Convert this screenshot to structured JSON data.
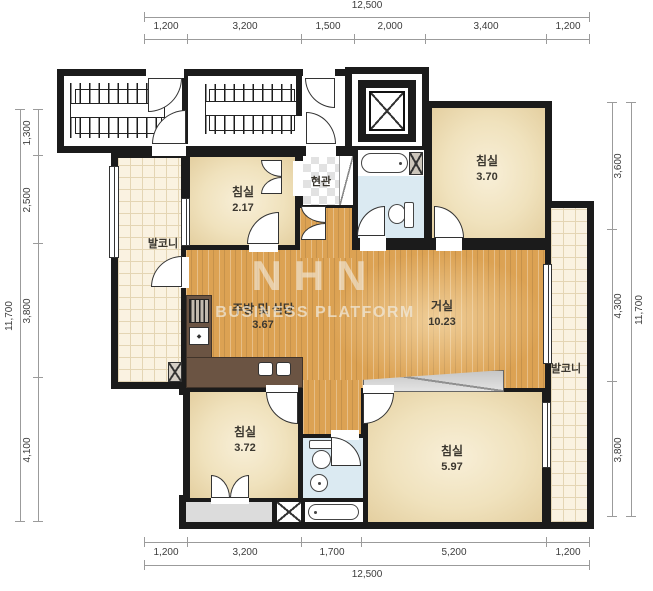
{
  "meta": {
    "type": "apartment-floor-plan"
  },
  "watermark": {
    "line1": "NHN",
    "line2": "BUSINESS PLATFORM"
  },
  "dimensions": {
    "top": {
      "total": "12,500",
      "segments": [
        "1,200",
        "3,200",
        "1,500",
        "2,000",
        "3,400",
        "1,200"
      ]
    },
    "bottom": {
      "total": "12,500",
      "segments": [
        "1,200",
        "3,200",
        "1,700",
        "5,200",
        "1,200"
      ]
    },
    "left": {
      "total": "11,700",
      "segments": [
        "1,300",
        "2,500",
        "3,800",
        "4,100"
      ]
    },
    "right": {
      "total": "11,700",
      "segments": [
        "3,600",
        "4,300",
        "3,800"
      ]
    }
  },
  "rooms": {
    "bedroom_top_left": {
      "name": "침실",
      "area": "2.17"
    },
    "bedroom_top_right": {
      "name": "침실",
      "area": "3.70"
    },
    "living_room": {
      "name": "거실",
      "area": "10.23"
    },
    "kitchen_dining": {
      "name": "주방 및 식당",
      "area": "3.67"
    },
    "bedroom_bottom_left": {
      "name": "침실",
      "area": "3.72"
    },
    "bedroom_bottom_right": {
      "name": "침실",
      "area": "5.97"
    },
    "balcony_left": {
      "name": "발코니"
    },
    "balcony_right": {
      "name": "발코니"
    },
    "entrance": {
      "name": "현관"
    }
  },
  "colors": {
    "wall": "#1b1b1b",
    "wood_floor": "#dca253",
    "room_cream": "#f0e2bd",
    "balcony_tile": "#faf2e1",
    "bathroom_blue": "#dbeaf2",
    "counter_brown": "#6b5443",
    "utility_gray": "#dcdcdc",
    "dimension_text": "#3c3c3c",
    "watermark": "#e9e2d4"
  }
}
